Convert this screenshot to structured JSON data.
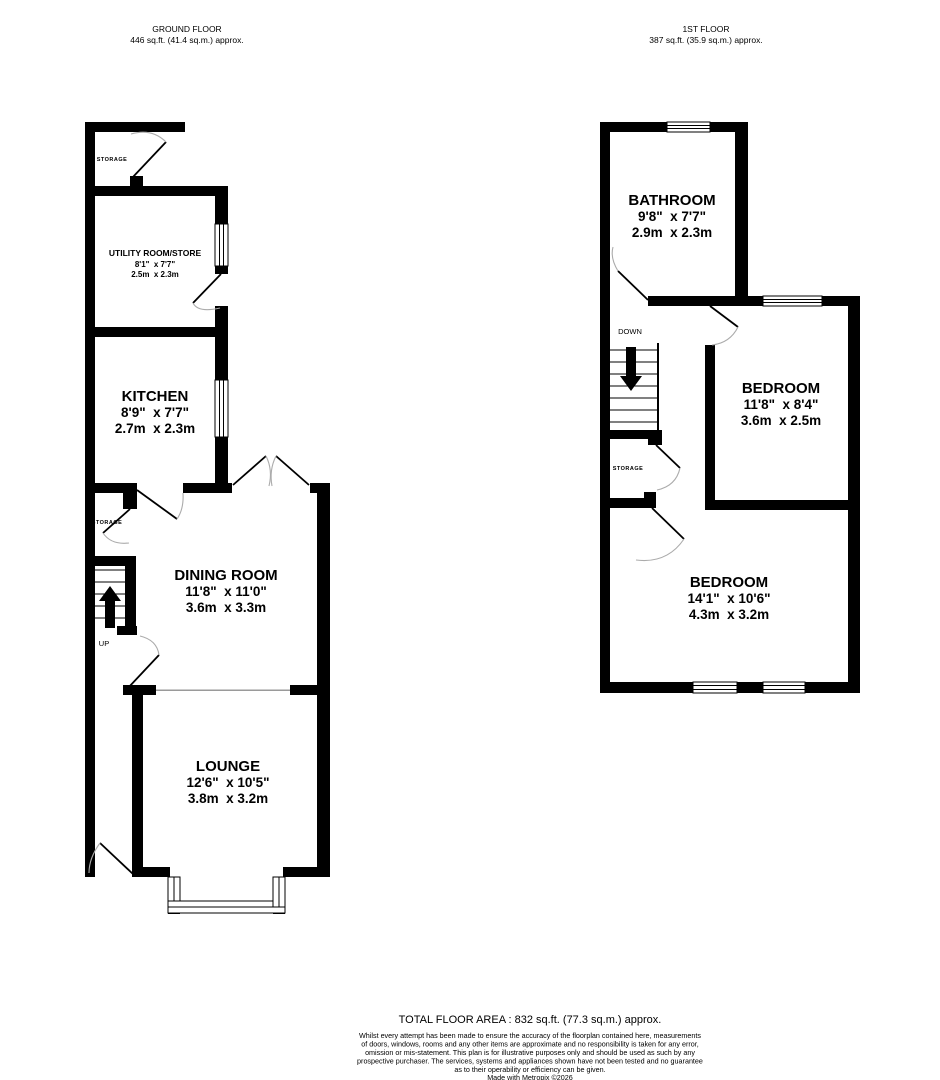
{
  "headers": {
    "ground": {
      "title": "GROUND FLOOR",
      "area": "446 sq.ft. (41.4 sq.m.) approx."
    },
    "first": {
      "title": "1ST FLOOR",
      "area": "387 sq.ft. (35.9 sq.m.) approx."
    }
  },
  "ground_floor": {
    "storage_top": {
      "label": "STORAGE"
    },
    "utility": {
      "name": "UTILITY ROOM/STORE",
      "imperial": "8'1\"  x 7'7\"",
      "metric": "2.5m  x 2.3m"
    },
    "kitchen": {
      "name": "KITCHEN",
      "imperial": "8'9\"  x 7'7\"",
      "metric": "2.7m  x 2.3m"
    },
    "storage_mid": {
      "label": "STORAGE"
    },
    "stairs": {
      "label": "UP"
    },
    "dining": {
      "name": "DINING ROOM",
      "imperial": "11'8\"  x 11'0\"",
      "metric": "3.6m  x 3.3m"
    },
    "lounge": {
      "name": "LOUNGE",
      "imperial": "12'6\"  x 10'5\"",
      "metric": "3.8m  x 3.2m"
    }
  },
  "first_floor": {
    "bathroom": {
      "name": "BATHROOM",
      "imperial": "9'8\"  x 7'7\"",
      "metric": "2.9m  x 2.3m"
    },
    "stairs": {
      "label": "DOWN"
    },
    "storage": {
      "label": "STORAGE"
    },
    "bedroom1": {
      "name": "BEDROOM",
      "imperial": "11'8\"  x 8'4\"",
      "metric": "3.6m  x 2.5m"
    },
    "bedroom2": {
      "name": "BEDROOM",
      "imperial": "14'1\"  x 10'6\"",
      "metric": "4.3m  x 3.2m"
    }
  },
  "footer": {
    "total": "TOTAL FLOOR AREA : 832 sq.ft. (77.3 sq.m.) approx.",
    "disclaimer": [
      "Whilst every attempt has been made to ensure the accuracy of the floorplan contained here, measurements",
      "of doors, windows, rooms and any other items are approximate and no responsibility is taken for any error,",
      "omission or mis-statement. This plan is for illustrative purposes only and should be used as such by any",
      "prospective purchaser. The services, systems and appliances shown have not been tested and no guarantee",
      "as to their operability or efficiency can be given."
    ],
    "credit": "Made with Metropix ©2026"
  }
}
